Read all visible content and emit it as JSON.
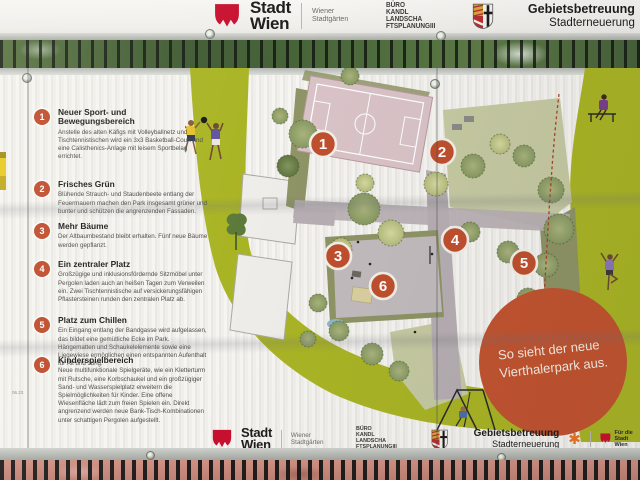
{
  "colors": {
    "banner_green": "#a9b424",
    "marker_orange": "#bf4f2d",
    "badge_orange": "#c1532f",
    "vienna_red": "#c8102e",
    "gb_star_orange": "#e8731e"
  },
  "logos": {
    "stadt_wien": {
      "top": "Stadt",
      "bottom": "Wien"
    },
    "stadtgaerten": {
      "top": "Wiener",
      "bottom": "Stadtgärten"
    },
    "buero_lines": [
      "BÜRO",
      "KANDL",
      "LANDSCHA",
      "FTSPLANUNGIII"
    ],
    "gebietsbetreuung": {
      "top": "Gebietsbetreuung",
      "bottom": "Stadterneuerung"
    },
    "fuer_die_stadt": {
      "top": "Für die",
      "bottom": "Stadt Wien"
    },
    "star_glyph": "✱"
  },
  "list": {
    "items": [
      {
        "num": "1",
        "title": "Neuer Sport- und Bewegungsbereich",
        "body": "Anstelle des alten Käfigs mit Volleyballnetz und Tischtennistischen wird ein 3x3 Basketball-Court und eine Calisthenics-Anlage mit leisem Sportbelag errichtet."
      },
      {
        "num": "2",
        "title": "Frisches Grün",
        "body": "Blühende Strauch- und Staudenbeete entlang der Feuermauern machen den Park insgesamt grüner und bunter und schützen die angrenzenden Fassaden."
      },
      {
        "num": "3",
        "title": "Mehr Bäume",
        "body": "Der Altbaumbestand bleibt erhalten. Fünf neue Bäume werden gepflanzt."
      },
      {
        "num": "4",
        "title": "Ein zentraler Platz",
        "body": "Großzügige und inklusionsfördernde Sitzmöbel unter Pergolen laden auch an heißen Tagen zum Verweilen ein. Zwei Tischtennistische auf versickerungsfähigen Pflastersteinen runden den zentralen Platz ab."
      },
      {
        "num": "5",
        "title": "Platz zum Chillen",
        "body": "Ein Eingang entlang der Bandgasse wird aufgelassen, das bildet eine gemütliche Ecke im Park. Hängematten und Schaukelelemente sowie eine Liegewiese ermöglichen einen entspannten Aufenthalt für Alt und Jung."
      },
      {
        "num": "6",
        "title": "Kinderspielbereich",
        "body": "Neue multifunktionale Spielgeräte, wie ein Kletterturm mit Rutsche, eine Korbschaukel und ein großzügiger Sand- und Wasserspielplatz erweitern die Spielmöglichkeiten für Kinder. Eine offene Wiesenfläche lädt zum freien Spielen ein. Direkt angrenzend werden neue Bank-Tisch-Kombinationen unter schattigen Pergolen aufgestellt."
      }
    ]
  },
  "map": {
    "markers": [
      "1",
      "2",
      "3",
      "4",
      "5",
      "6"
    ],
    "badge": {
      "line1": "So sieht der neue",
      "line2": "Vierthalerpark aus."
    },
    "corner_note": "06.23"
  }
}
